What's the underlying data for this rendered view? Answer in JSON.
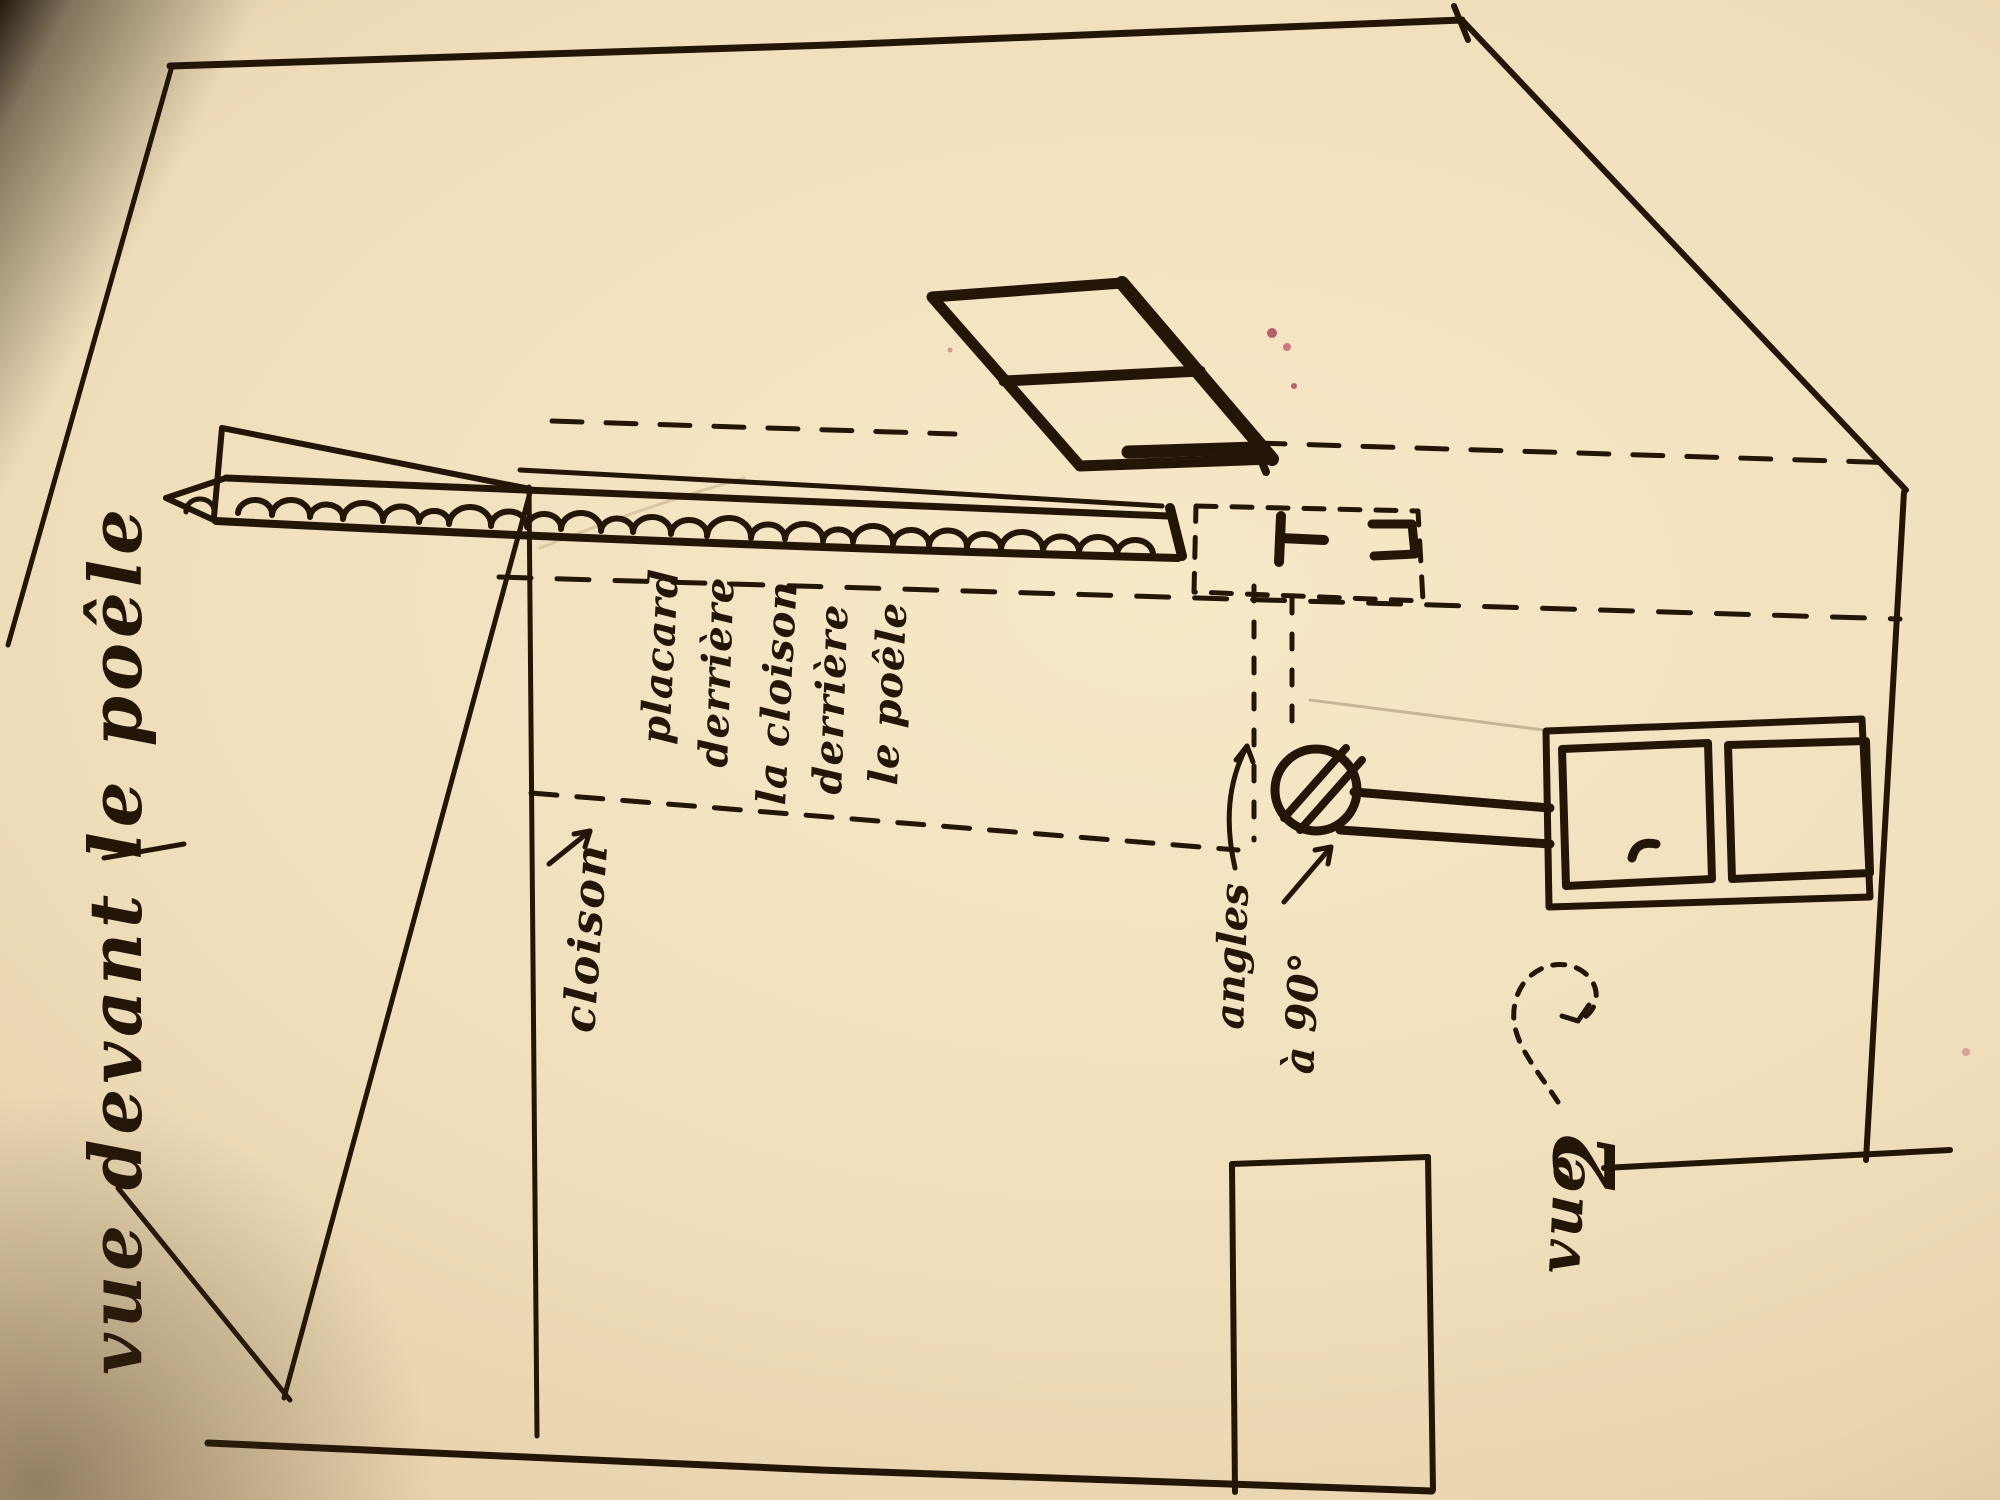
{
  "labels": {
    "view_title": "vue devant le poêle",
    "partition": "cloison",
    "closet_note_lines": [
      "placard",
      "derrière",
      "la cloison",
      "derrière",
      "le poêle"
    ],
    "angle_note_line1": "angles",
    "angle_note_line2": "à 90°",
    "view2_word": "vue",
    "view2_number": "2"
  },
  "colors": {
    "ink": "#241607",
    "paper": "#f1dfbc",
    "paper_shadow": "#d3ba92",
    "stain_red": "#b4606a"
  }
}
